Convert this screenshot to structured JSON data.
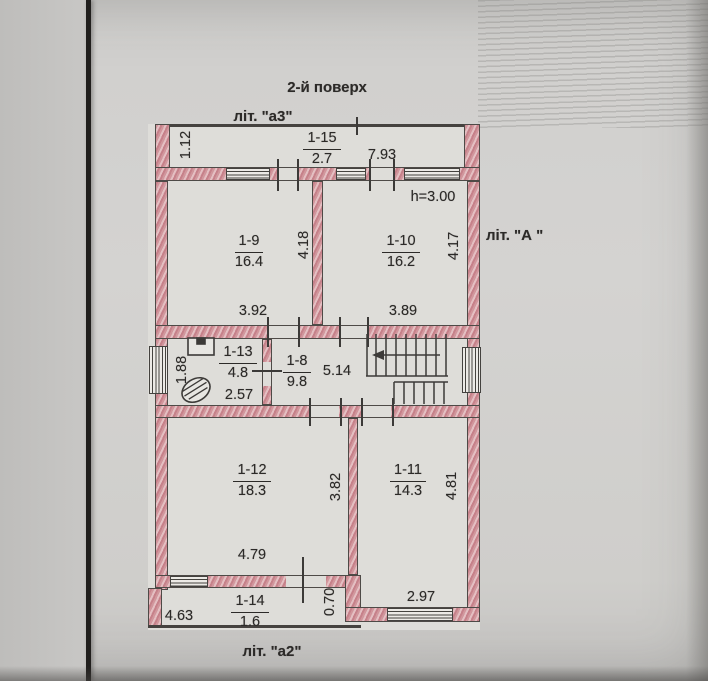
{
  "page": {
    "title": "2-й  поверх"
  },
  "plan": {
    "liter_top": "літ. \"а3\"",
    "liter_right": "літ. \"А \"",
    "liter_bottom": "літ. \"а2\"",
    "ceiling_height": "h=3.00",
    "rooms": {
      "balcony_top": {
        "number": "1-15",
        "area": "2.7",
        "width": "7.93",
        "depth": "1.12"
      },
      "room9": {
        "number": "1-9",
        "area": "16.4",
        "depth": "4.18",
        "width": "3.92"
      },
      "room10": {
        "number": "1-10",
        "area": "16.2",
        "depth": "4.17",
        "width": "3.89"
      },
      "room13": {
        "number": "1-13",
        "area": "4.8",
        "depth": "1.88",
        "width": "2.57"
      },
      "room8": {
        "number": "1-8",
        "area": "9.8",
        "hall_width": "5.14"
      },
      "stair_window": {
        "width": "1.90"
      },
      "room12": {
        "number": "1-12",
        "area": "18.3",
        "depth": "3.82",
        "width": "4.79"
      },
      "room11": {
        "number": "1-11",
        "area": "14.3",
        "depth": "4.81",
        "width": "2.97"
      },
      "balcony_bottom": {
        "number": "1-14",
        "area": "1.6",
        "left_width": "4.63",
        "right_depth": "0.70"
      }
    }
  }
}
